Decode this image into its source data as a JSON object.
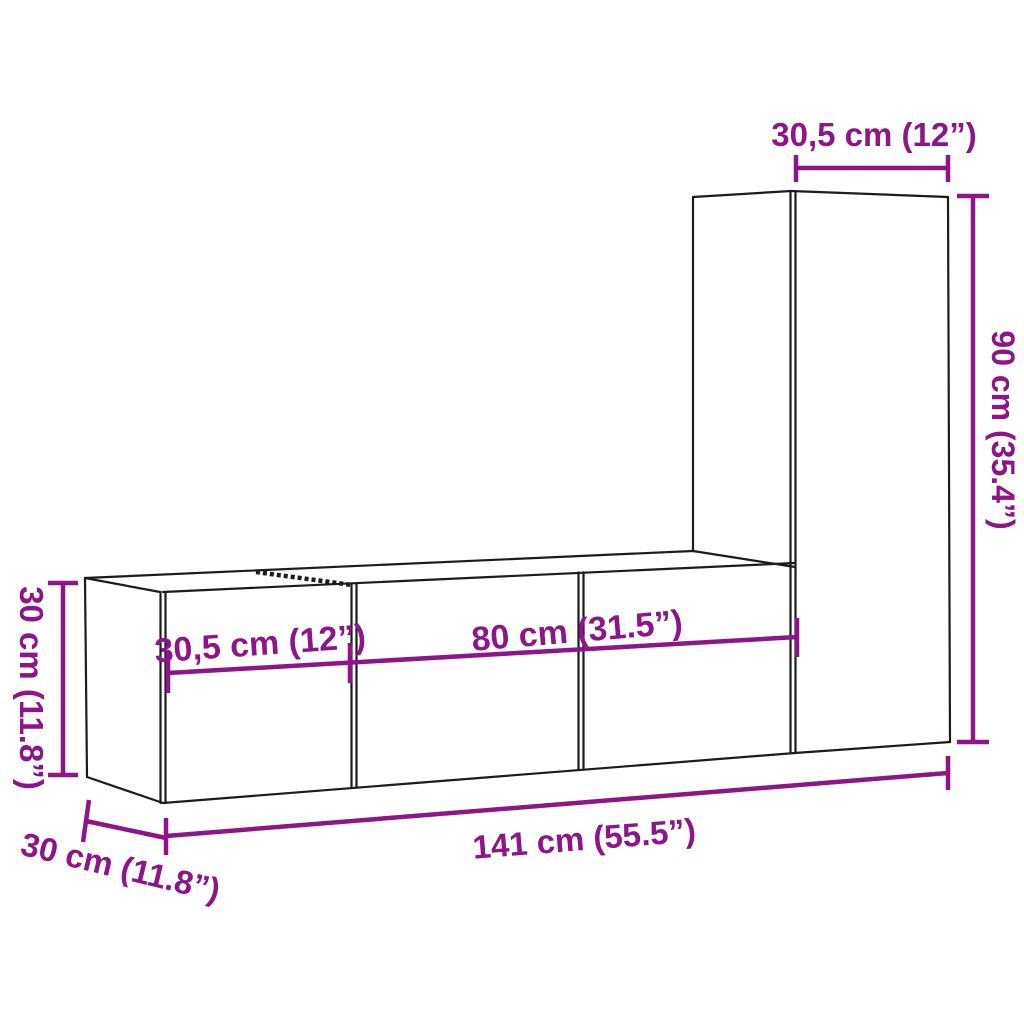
{
  "diagram": {
    "kind": "furniture dimension drawing",
    "background_color": "#ffffff",
    "outline_color": "#1c1c1c",
    "dimension_color": "#8d1589",
    "labels": {
      "top_width": {
        "text": "30,5 cm (12”)",
        "cm": "30,5",
        "inches": "12"
      },
      "right_height": {
        "text": "90 cm (35.4”)",
        "cm": "90",
        "inches": "35.4"
      },
      "left_height": {
        "text": "30 cm (11.8”)",
        "cm": "30",
        "inches": "11.8"
      },
      "front_left_width": {
        "text": "30,5 cm (12”)",
        "cm": "30,5",
        "inches": "12"
      },
      "front_middle_width": {
        "text": "80 cm (31.5”)",
        "cm": "80",
        "inches": "31.5"
      },
      "total_width": {
        "text": "141 cm (55.5”)",
        "cm": "141",
        "inches": "55.5"
      },
      "depth": {
        "text": "30 cm (11.8”)",
        "cm": "30",
        "inches": "11.8"
      }
    }
  }
}
